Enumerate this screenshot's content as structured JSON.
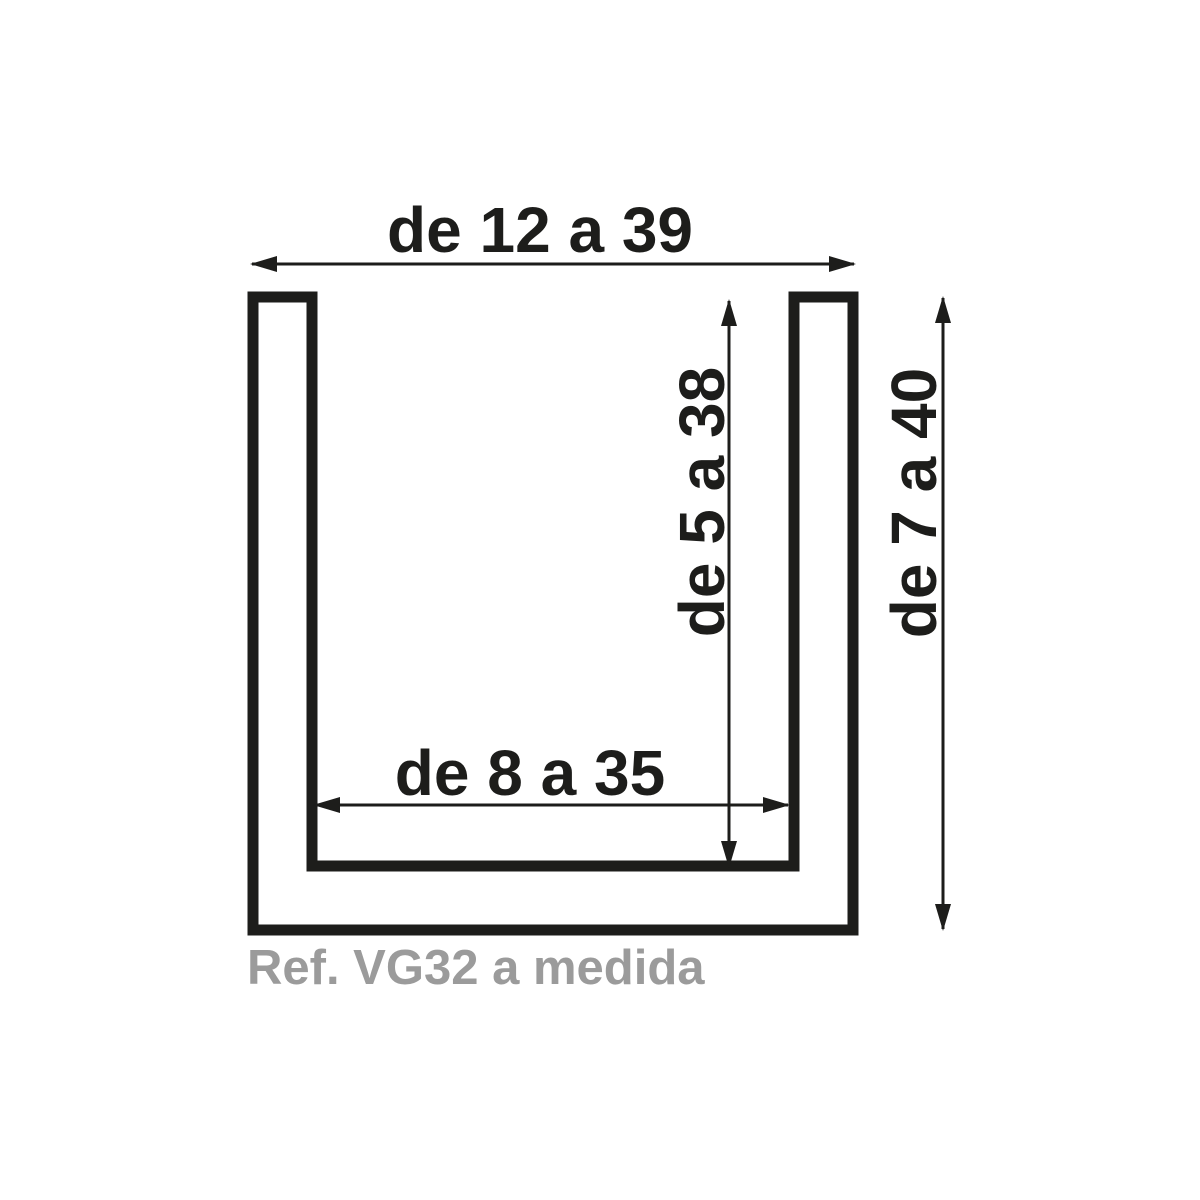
{
  "diagram": {
    "type": "u-channel-profile-cross-section",
    "ref_label": "Ref. VG32 a medida",
    "dims": {
      "outer_width": "de 12 a 39",
      "inner_height": "de 5 a 38",
      "outer_height": "de 7 a 40",
      "inner_width": "de 8 a 35"
    },
    "colors": {
      "line": "#1d1d1b",
      "ref_text": "#9b9b9b",
      "background": "#ffffff"
    }
  }
}
